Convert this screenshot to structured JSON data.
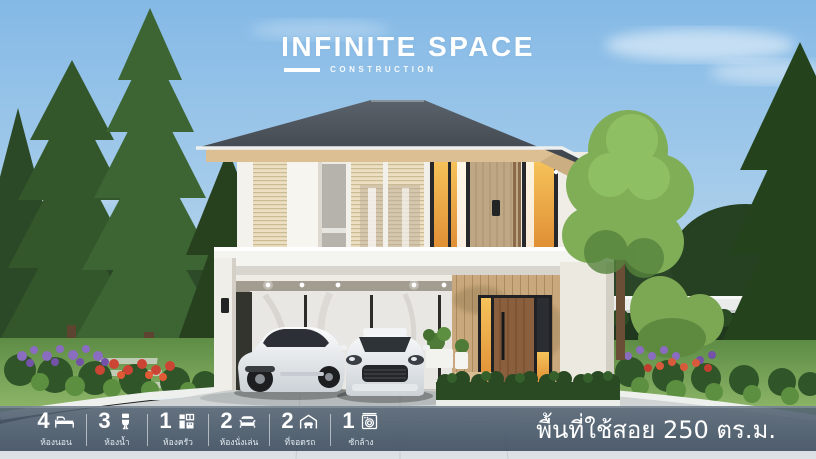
{
  "logo": {
    "title": "INFINITE SPACE",
    "subtitle": "CONSTRUCTION"
  },
  "specs": {
    "items": [
      {
        "value": "4",
        "label": "ห้องนอน",
        "icon": "bed-icon"
      },
      {
        "value": "3",
        "label": "ห้องน้ำ",
        "icon": "toilet-icon"
      },
      {
        "value": "1",
        "label": "ห้องครัว",
        "icon": "kitchen-icon"
      },
      {
        "value": "2",
        "label": "ห้องนั่งเล่น",
        "icon": "sofa-icon"
      },
      {
        "value": "2",
        "label": "ที่จอดรถ",
        "icon": "car-garage-icon"
      },
      {
        "value": "1",
        "label": "ซักล้าง",
        "icon": "washing-machine-icon"
      }
    ]
  },
  "area": {
    "text": "พื้นที่ใช้สอย 250 ตร.ม."
  },
  "palette": {
    "sky_top": "#84b9e6",
    "sky_bottom": "#cfe3f2",
    "roof": "#363c43",
    "wood_accent": "#c9a97d",
    "warm_window_light": "#f2a942",
    "wall_white": "#f2efe8",
    "tree_green": "#2e4d28",
    "bar_background": "#46586a",
    "text_white": "#ffffff"
  }
}
